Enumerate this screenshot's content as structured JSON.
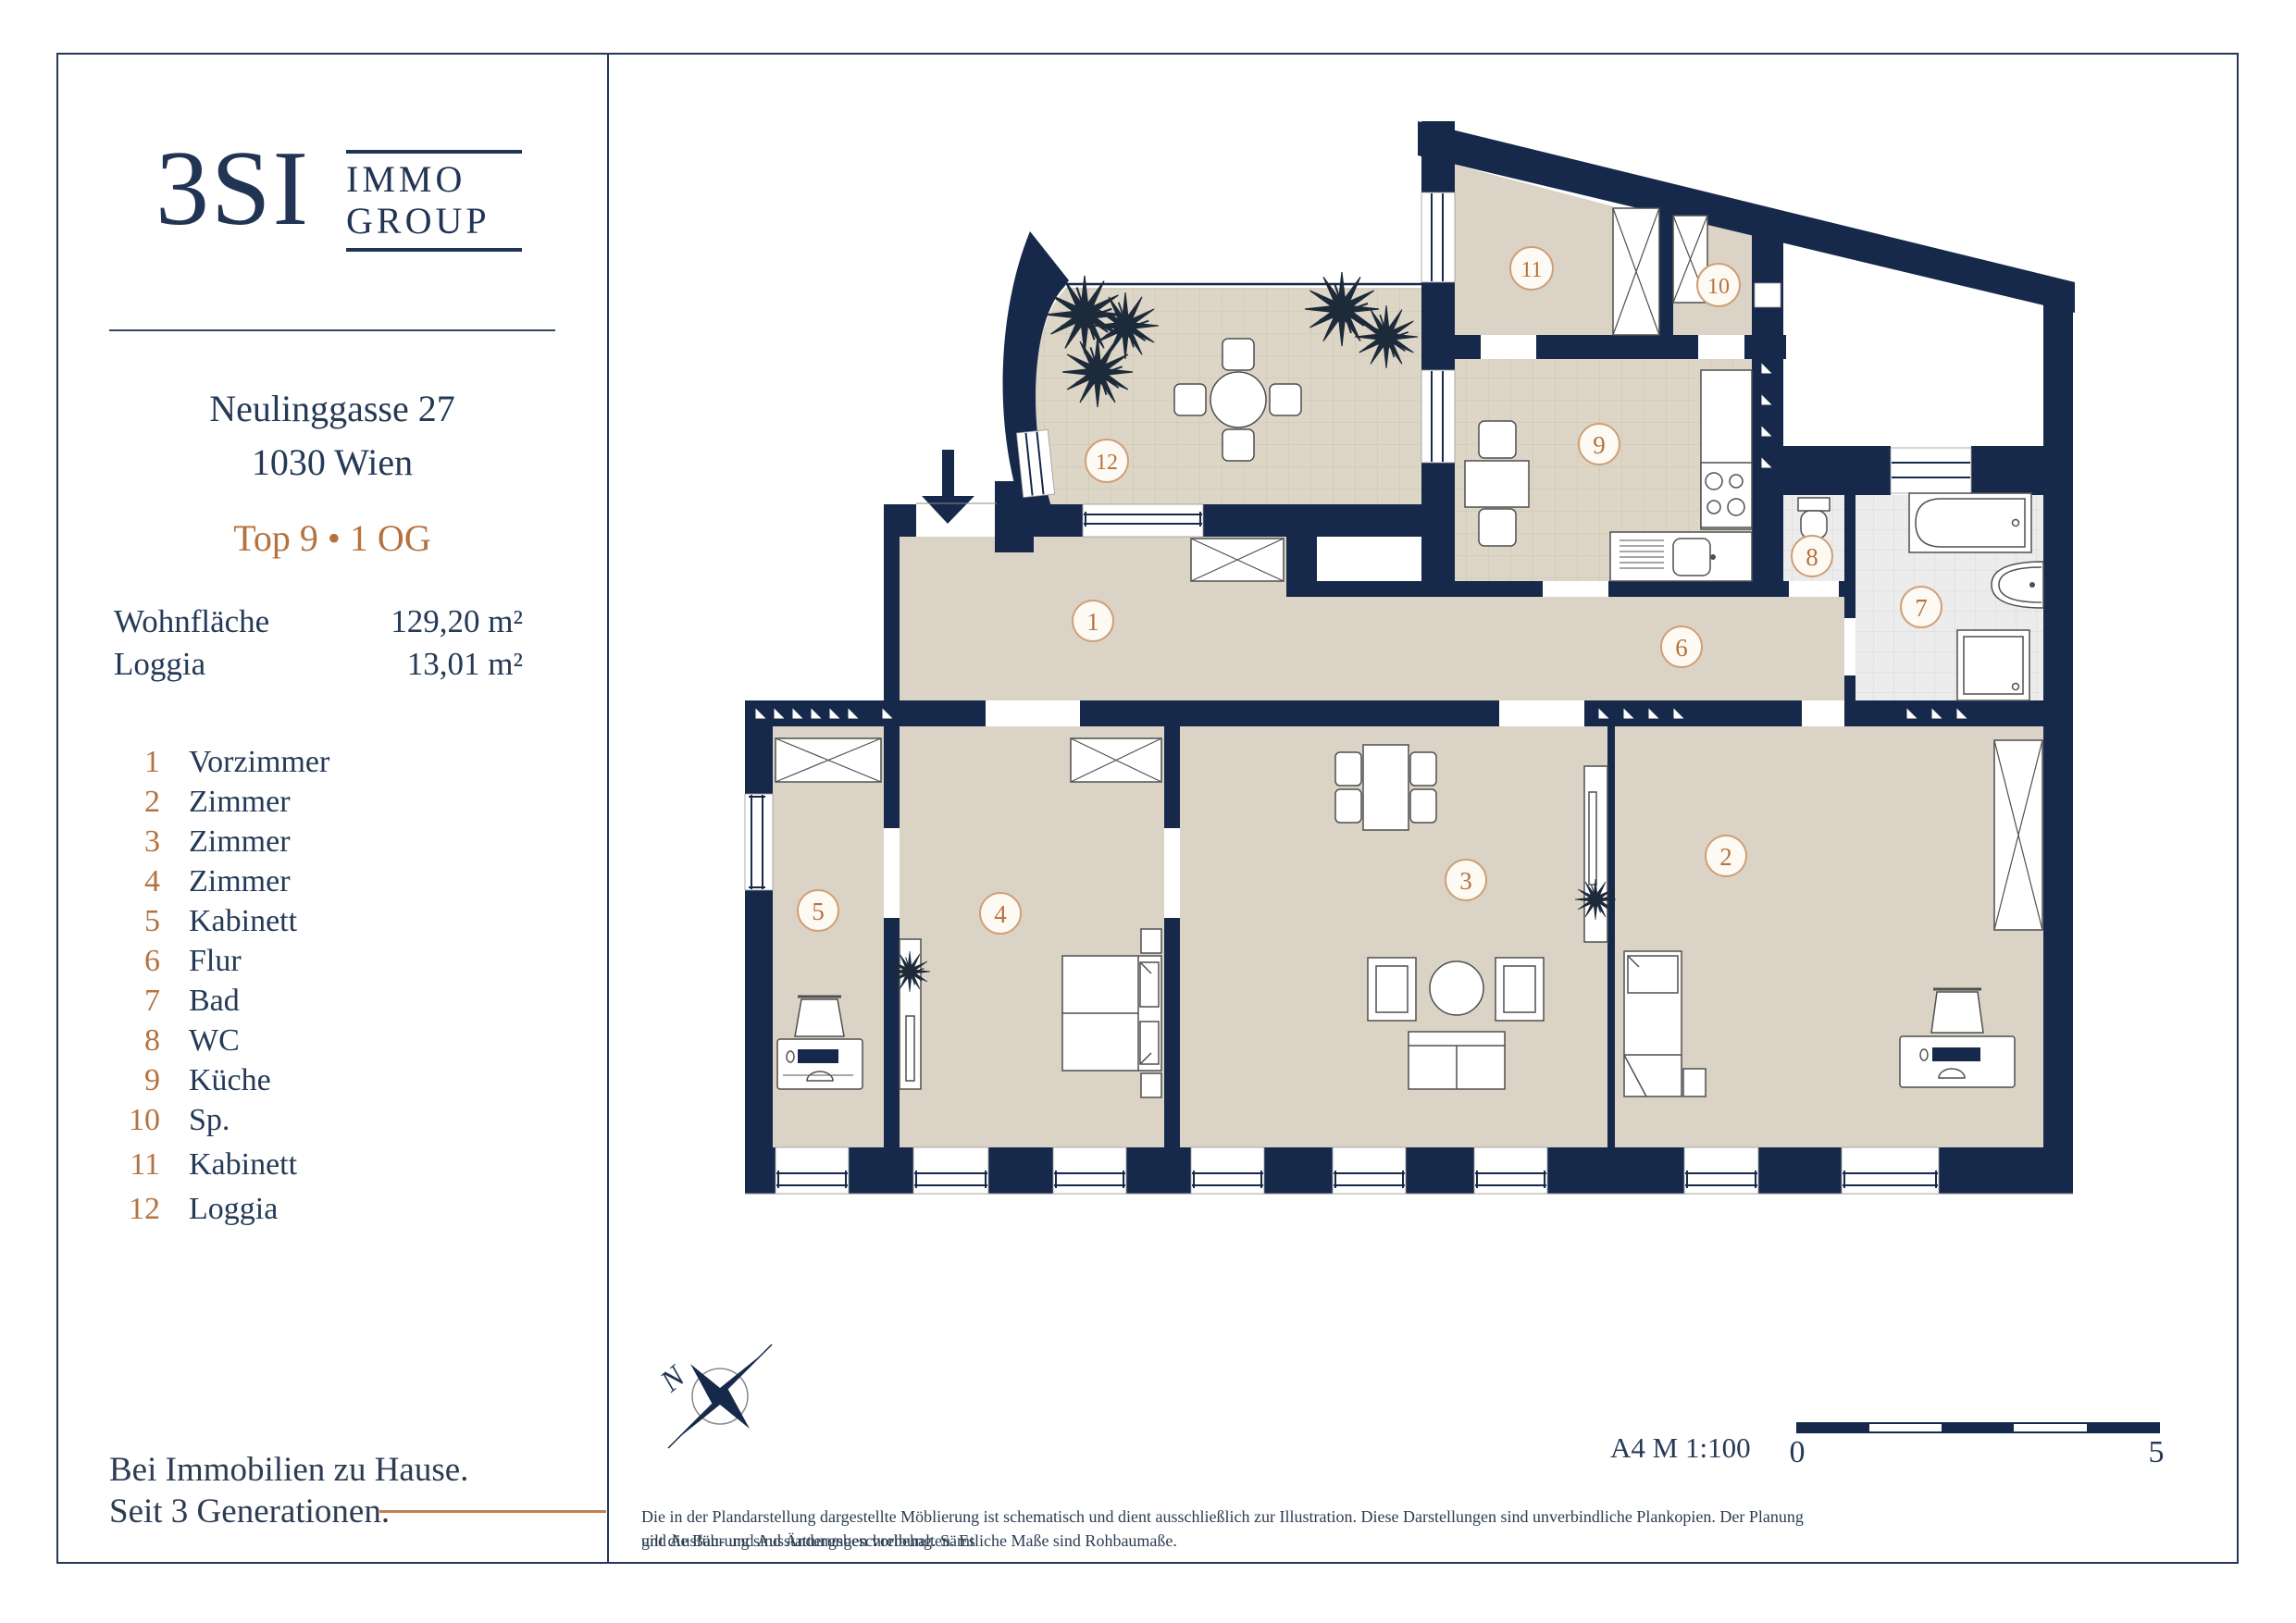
{
  "brand": {
    "name": "3SI",
    "line1": "IMMO",
    "line2": "GROUP"
  },
  "property": {
    "street": "Neulinggasse 27",
    "city": "1030 Wien",
    "unit": "Top 9 • 1 OG"
  },
  "areas": [
    {
      "label": "Wohnfläche",
      "value": "129,20 m²"
    },
    {
      "label": "Loggia",
      "value": "13,01 m²"
    }
  ],
  "rooms": [
    {
      "number": "1",
      "name": "Vorzimmer"
    },
    {
      "number": "2",
      "name": "Zimmer"
    },
    {
      "number": "3",
      "name": "Zimmer"
    },
    {
      "number": "4",
      "name": "Zimmer"
    },
    {
      "number": "5",
      "name": "Kabinett"
    },
    {
      "number": "6",
      "name": "Flur"
    },
    {
      "number": "7",
      "name": "Bad"
    },
    {
      "number": "8",
      "name": "WC"
    },
    {
      "number": "9",
      "name": "Küche"
    },
    {
      "number": "10",
      "name": "Sp."
    },
    {
      "number": "11",
      "name": "Kabinett"
    },
    {
      "number": "12",
      "name": "Loggia"
    }
  ],
  "tagline": {
    "line1": "Bei Immobilien zu Hause.",
    "line2": "Seit 3 Generationen."
  },
  "plan": {
    "compass": "N",
    "scale_text": "A4  M 1:100",
    "scale_start": "0",
    "scale_end": "5"
  },
  "disclaimer": {
    "line1": "Die in der Plandarstellung dargestellte Möblierung ist schematisch und dient ausschließlich zur Illustration. Diese Darstellungen sind unverbindliche Plankopien. Der Planung und Ausführung sind Änderungen vorbehalten. Es",
    "line2": "gilt die Bau- und Ausstattungsbeschreibung. Sämtliche Maße sind Rohbaumaße."
  },
  "colors": {
    "navy": "#16294a",
    "copper": "#b5723f",
    "floor_beige": "#dbd3c5",
    "tile_gray": "#ececec"
  }
}
